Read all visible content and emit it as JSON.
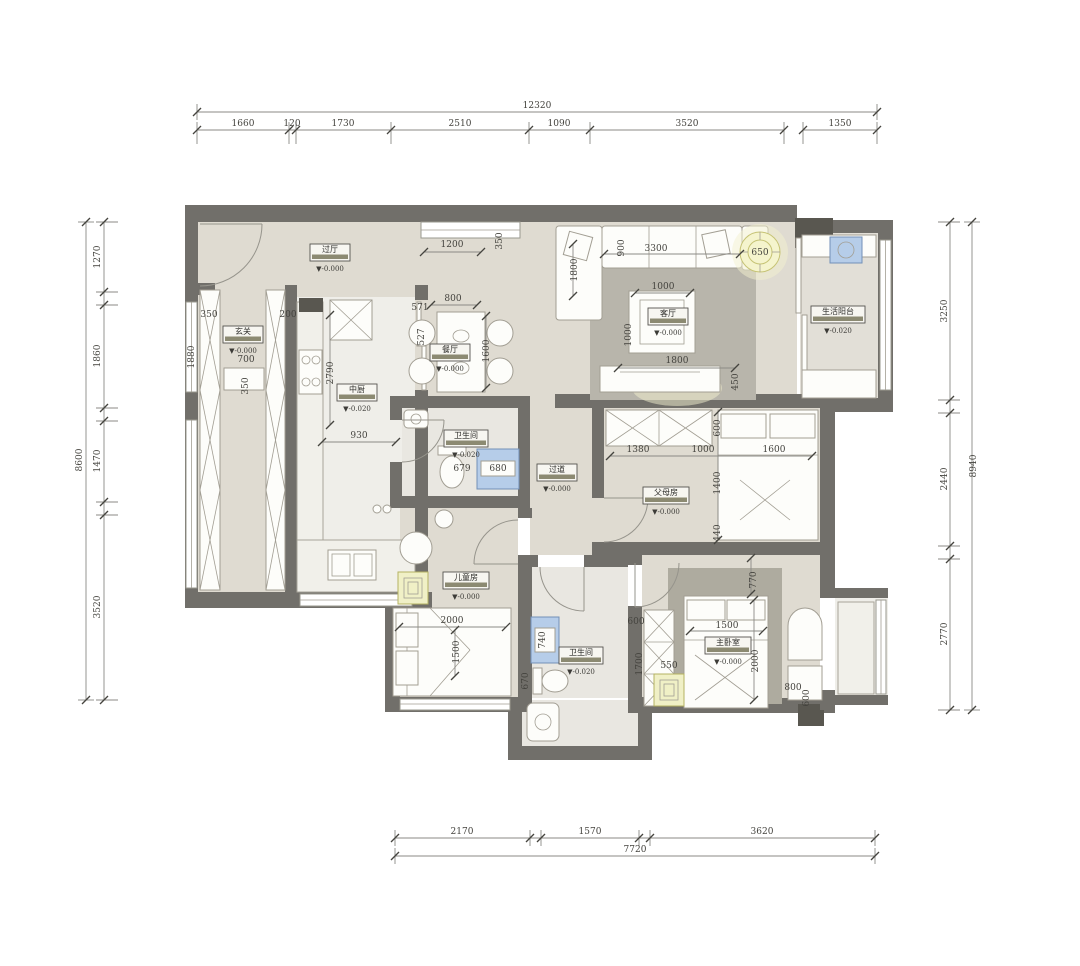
{
  "rooms": {
    "foyer": {
      "name": "过厅",
      "level": "▼-0.000"
    },
    "entry": {
      "name": "玄关",
      "level": "▼-0.000"
    },
    "kitchen": {
      "name": "中厨",
      "level": "▼-0.020"
    },
    "dining": {
      "name": "餐厅",
      "level": "▼-0.000"
    },
    "living": {
      "name": "客厅",
      "level": "▼-0.000"
    },
    "balcony": {
      "name": "生活阳台",
      "level": "▼-0.020"
    },
    "bath1": {
      "name": "卫生间",
      "level": "▼-0.020"
    },
    "corridor": {
      "name": "过道",
      "level": "▼-0.000"
    },
    "parents": {
      "name": "父母房",
      "level": "▼-0.000"
    },
    "kids": {
      "name": "儿童房",
      "level": "▼-0.000"
    },
    "bath2": {
      "name": "卫生间",
      "level": "▼-0.020"
    },
    "master": {
      "name": "主卧室",
      "level": "▼-0.000"
    }
  },
  "dims": {
    "top": {
      "total": "12320",
      "segs": [
        "1660",
        "120",
        "1730",
        "2510",
        "1090",
        "3520",
        "1350"
      ]
    },
    "left": {
      "total": "8600",
      "segs": [
        "1270",
        "1860",
        "1470",
        "3520"
      ]
    },
    "right": {
      "total": "8940",
      "segs": [
        "3250",
        "2440",
        "2770"
      ]
    },
    "bottom": {
      "total": "7720",
      "segs": [
        "2170",
        "1570",
        "3620"
      ]
    },
    "interior": {
      "win_foyer": "1200",
      "win_foyer_d": "350",
      "entry_cab_a": "350",
      "entry_cab_b": "200",
      "entry_h": "1880",
      "bench_w": "700",
      "bench_d": "350",
      "kitchen_l": "2790",
      "kitchen_w": "930",
      "dining_w": "800",
      "chair_w": "571",
      "chair_d": "527",
      "table_l": "1600",
      "chaise_l": "1800",
      "sofa_d": "900",
      "sofa_l": "3300",
      "fan_d": "650",
      "ctable_w": "1000",
      "ctable_d": "1000",
      "tv_w": "1800",
      "tv_d": "450",
      "bath1_wc": "679",
      "bath1_shower": "680",
      "par_ward": "1380",
      "par_gap": "1000",
      "par_bed": "1600",
      "par_s1": "600",
      "par_s2": "1400",
      "par_s3": "440",
      "kid_bed_l": "2000",
      "kid_bed_w": "1500",
      "bath2_shower": "740",
      "bath2_wc": "670",
      "mst_s1": "770",
      "mst_bed_w": "1500",
      "mst_bed_l": "2000",
      "mst_ward_w": "600",
      "mst_ward_l": "1700",
      "mst_rug": "550",
      "mst_tbl": "800",
      "mst_tbl_d": "600"
    }
  }
}
